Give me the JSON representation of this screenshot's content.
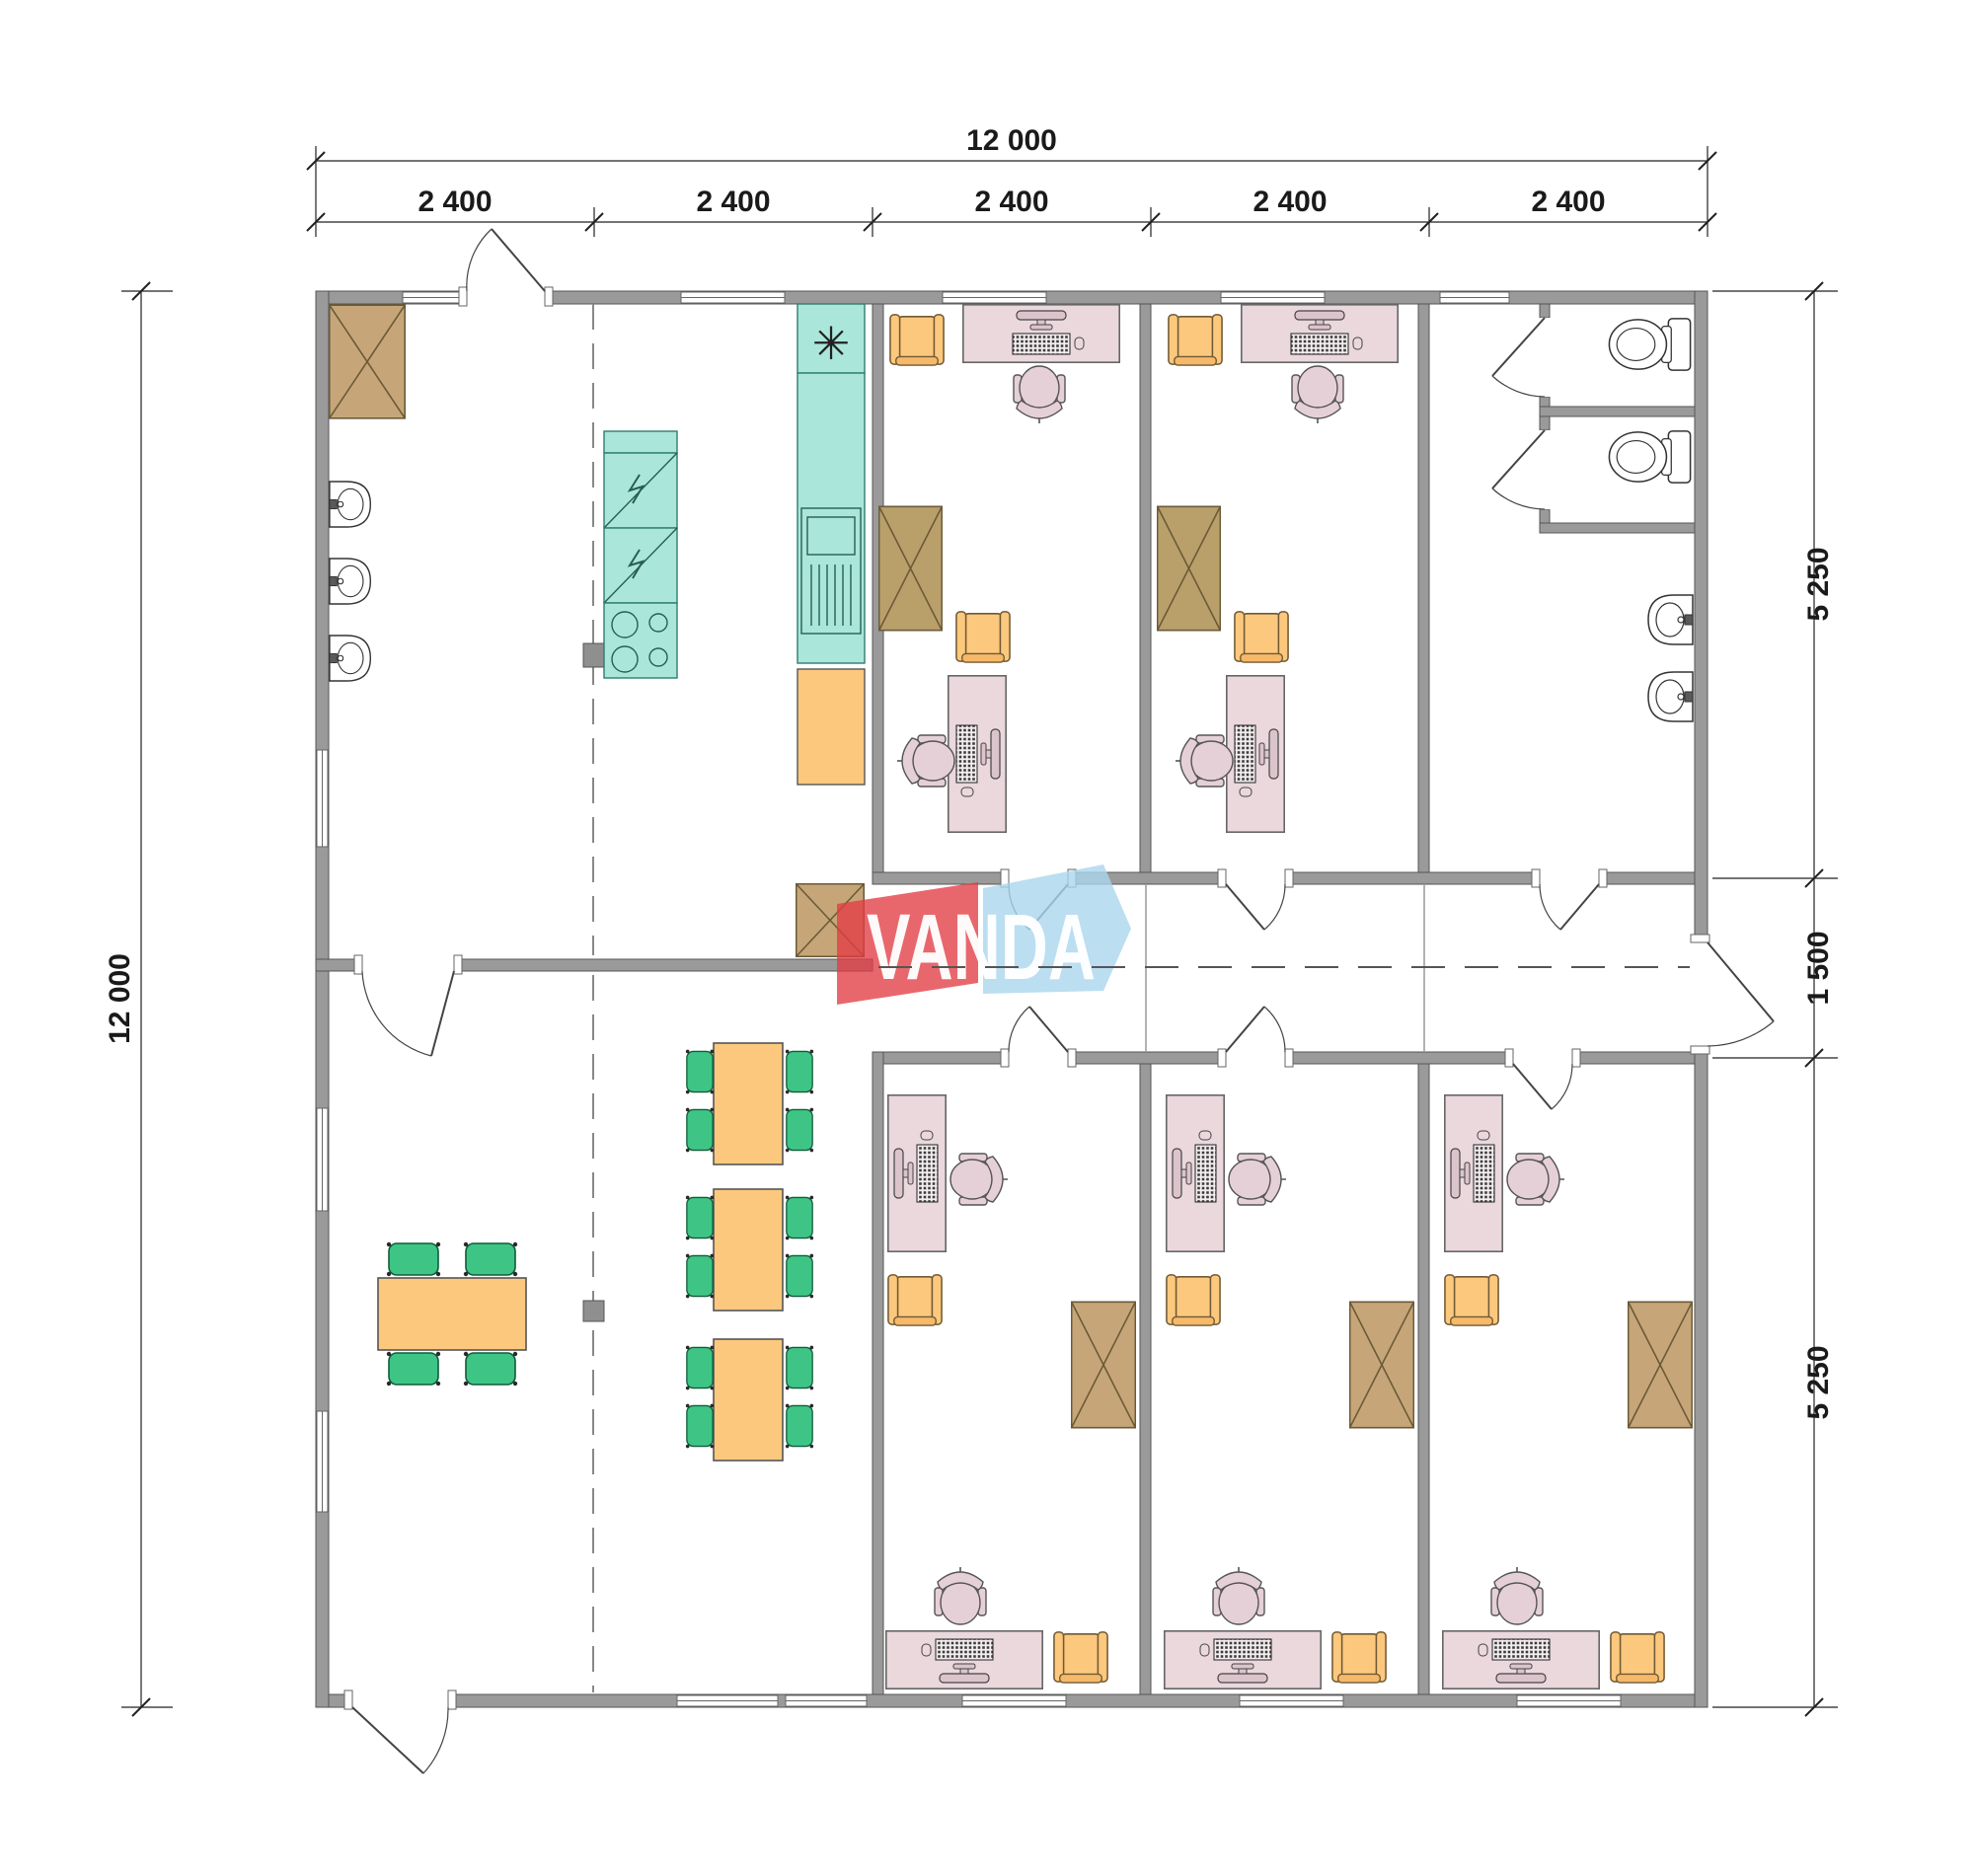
{
  "page": {
    "background": "#ffffff"
  },
  "plan": {
    "logo": {
      "text": "VANDA",
      "red_color": "#e23c44",
      "blue_color": "#aad6ee"
    },
    "kitchen": {
      "extractor_symbol": "✳"
    },
    "dimensions": {
      "top_total": "12 000",
      "top_modules": [
        "2 400",
        "2 400",
        "2 400",
        "2 400",
        "2 400"
      ],
      "left_total": "12 000",
      "right_top": "5 250",
      "right_middle": "1 500",
      "right_bottom": "5 250"
    },
    "colors": {
      "wall": "#9a9a9a",
      "furniture_wood": "#c6a678",
      "furniture_orange": "#fcc87e",
      "furniture_pink": "#ead8dd",
      "furniture_green": "#3ec586",
      "kitchen_teal": "#aae7da"
    }
  }
}
